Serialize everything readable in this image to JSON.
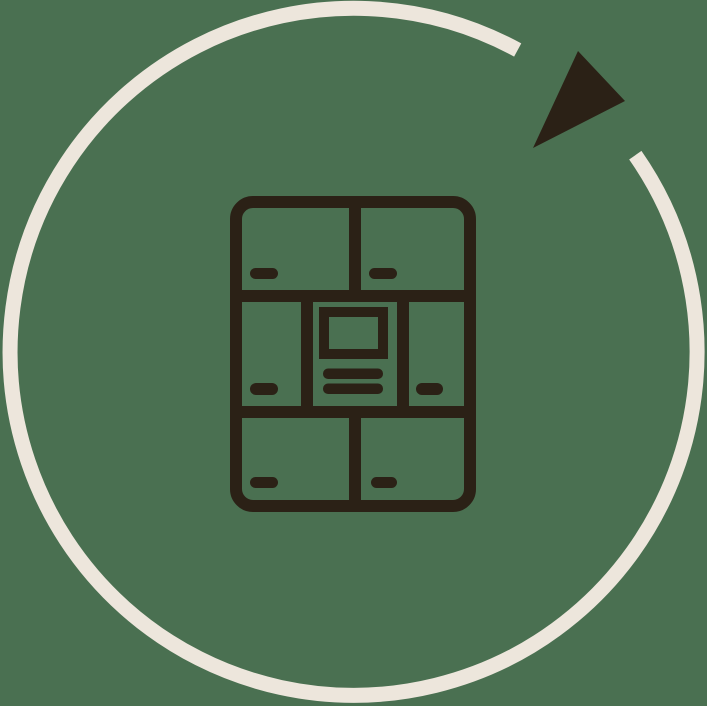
{
  "illustration": {
    "description": "Circular rotation arrow enclosing a locker cabinet icon",
    "colors": {
      "background": "#4A7051",
      "arc": "#EDE6DC",
      "icon": "#2B2116"
    },
    "icons": [
      "rotation-arc",
      "rotation-arrowhead-icon",
      "lockers-icon"
    ]
  }
}
